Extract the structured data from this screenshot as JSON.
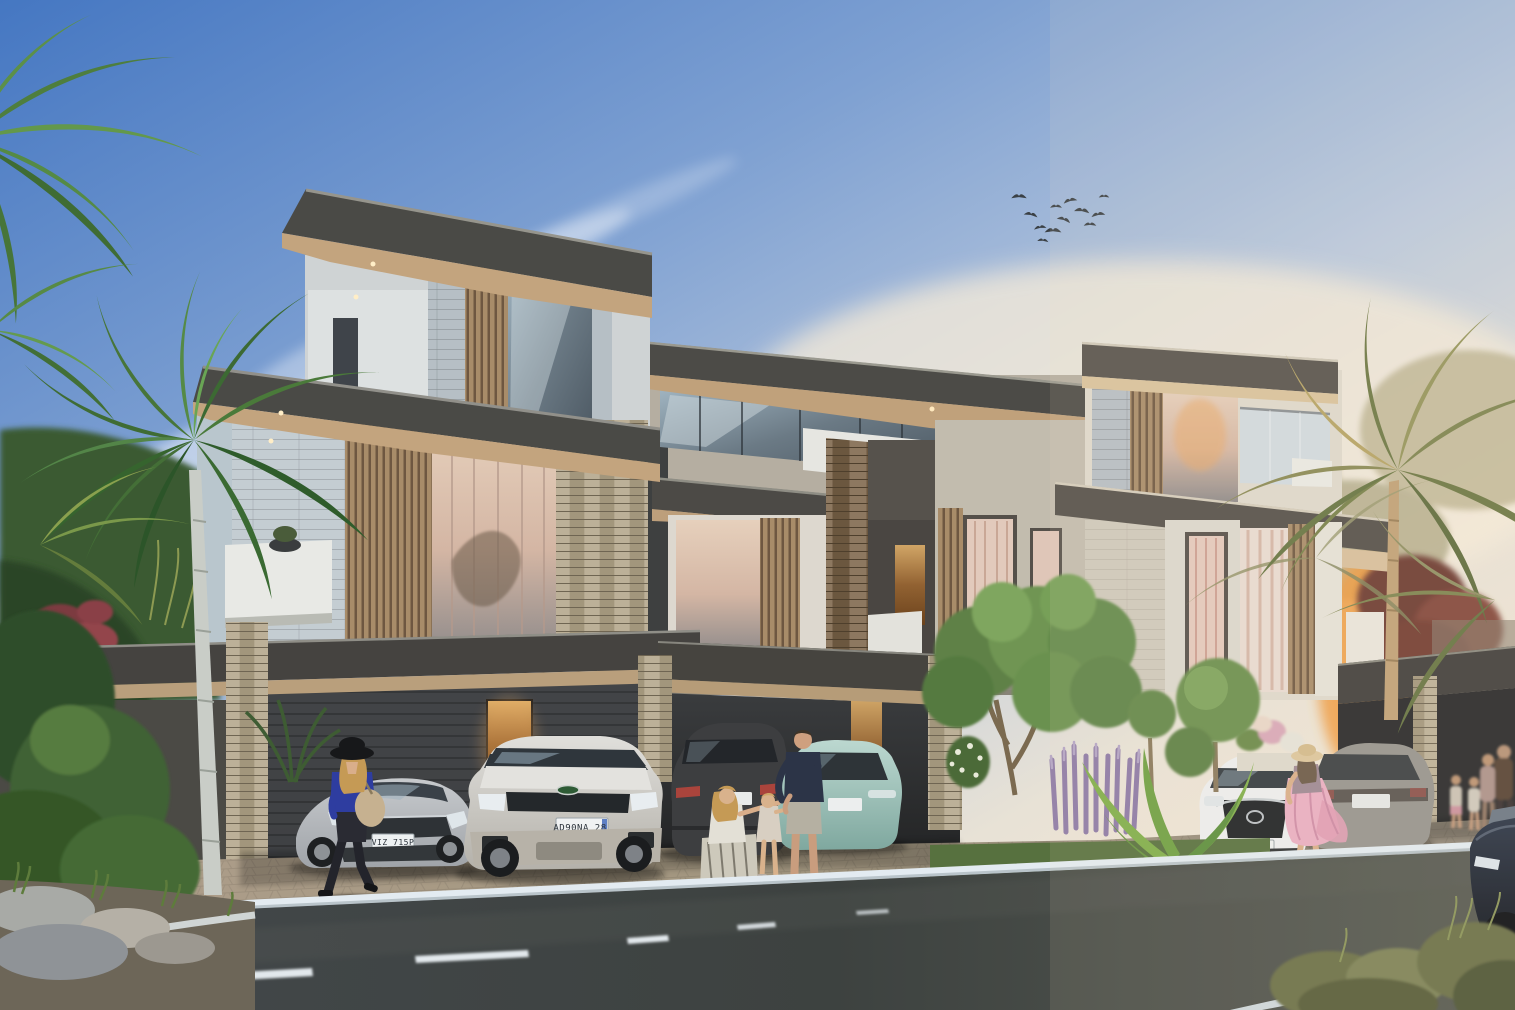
{
  "scene": {
    "type": "architectural-exterior-rendering",
    "subject": "modern three-storey villa townhouses at dusk with street, cars, pedestrians and palms",
    "sky": {
      "top": "#4577c2",
      "mid": "#8fa9d4",
      "horizon_right": "#f6e9d3",
      "clouds": "#ffffff"
    },
    "birds": {
      "count": 12,
      "color": "#3a4045"
    },
    "building": {
      "fascia": "#4a4a46",
      "soffit_warm": "#c3a47e",
      "stone_light": "#c4cdd2",
      "stone_beige_pier": "#b3a78f",
      "stone_brown_column": "#7c6750",
      "louver_wood": "#a88c69",
      "glass_cool": "#6b7a85",
      "glass_warm": "#d9bfae",
      "parapet_white": "#e8e9e5",
      "carport_interior": "#2c2e30",
      "lit_door": "#c98f4e"
    },
    "ground": {
      "paver_light": "#b3a391",
      "paver_dark": "#93887a",
      "curb": "#e3ebf1",
      "asphalt": "#40454a",
      "lane_marking": "#e2e8ec"
    },
    "vegetation": {
      "palm_green": "#4f7d3d",
      "palm_warm_olive": "#8f8f55",
      "topiary_green": "#6b8f4d",
      "lavender_spikes": "#9b89b0",
      "tropical_leaf": "#7fae4a",
      "red_shrub": "#7c3a41",
      "grass": "#57713f"
    },
    "cars": [
      {
        "name": "silver-sedan",
        "color": "#b9bcc0",
        "plate": "VIZ 715P"
      },
      {
        "name": "white-discovery-suv",
        "color": "#d8d7d3",
        "plate": "AD90NA 28"
      },
      {
        "name": "charcoal-suv-rear",
        "color": "#3b3c3e",
        "plate": ""
      },
      {
        "name": "teal-hatchback-rear",
        "color": "#9fc4bd",
        "plate": ""
      },
      {
        "name": "white-mazda-cx5",
        "color": "#e8e9ea",
        "plate": "43A 517"
      },
      {
        "name": "gray-sedan-rear",
        "color": "#96948e",
        "plate": ""
      },
      {
        "name": "navy-car-foreground",
        "color": "#232c3c",
        "plate": ""
      }
    ],
    "people": [
      {
        "name": "woman-black-hat-blue-top",
        "position": "left-sidewalk"
      },
      {
        "name": "kneeling-mother",
        "position": "center"
      },
      {
        "name": "little-girl",
        "position": "center"
      },
      {
        "name": "man-navy-tshirt-shorts",
        "position": "center"
      },
      {
        "name": "woman-pink-dress-straw-hat",
        "position": "right"
      },
      {
        "name": "family-group",
        "position": "far-right"
      }
    ]
  }
}
